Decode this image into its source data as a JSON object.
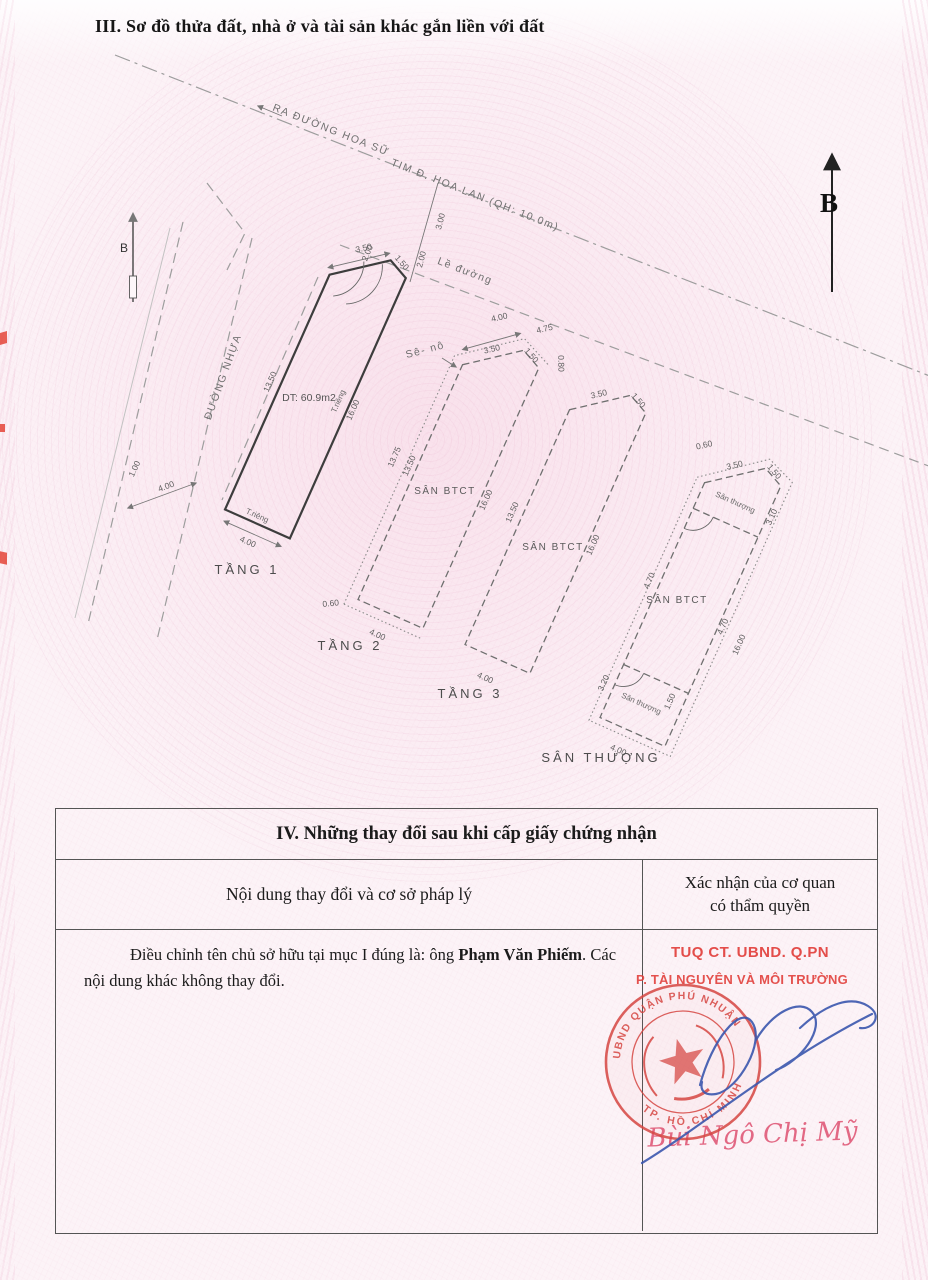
{
  "page": {
    "section3_title": "III. Sơ đồ thửa đất, nhà ở và tài sản khác gắn liền với đất"
  },
  "diagram": {
    "north": "B",
    "hoa_su": "RA ĐƯỜNG HOA SỮ",
    "hoa_lan": "TIM Đ. HOA LAN (QH: 10.0m)",
    "le_duong": "Lề đường",
    "duong_nhua": "ĐƯỜNG NHỰA",
    "road_w1": "4.00",
    "road_w2": "1.00",
    "tick1": "3.00",
    "tick2": "2.00",
    "f1": {
      "label": "TẦNG 1",
      "area": "DT: 60.9m2",
      "wall": "T.riêng",
      "d_chamfer": "3.50",
      "d_top": "1.50",
      "d_offset": "2.00",
      "d_left": "13.50",
      "d_right": "16.00",
      "d_bottom": "4.00"
    },
    "f2": {
      "label": "TẦNG 2",
      "canopy": "Sê- nô",
      "yard": "SÂN BTCT",
      "d_canopy_top": "4.00",
      "d_canopy_diag": "4.75",
      "d_canopy_r": "0.80",
      "d_chamfer": "3.50",
      "d_top": "1.50",
      "d_left_out": "13.75",
      "d_left": "13.50",
      "d_right": "16.00",
      "d_bl": "0.60",
      "d_bottom": "4.00"
    },
    "f3": {
      "label": "TẦNG 3",
      "yard": "SÂN BTCT",
      "d_chamfer": "3.50",
      "d_top": "1.50",
      "d_left": "13.50",
      "d_right": "16.00",
      "d_bottom": "4.00"
    },
    "f4": {
      "label": "SÂN THƯỢNG",
      "terrace": "Sân thượng",
      "yard": "SÂN BTCT",
      "d_tl": "0.60",
      "d_chamfer": "3.50",
      "d_top": "1.50",
      "d_ur": "3.10",
      "d_ml": "4.70",
      "d_mr": "4.70",
      "d_right": "16.00",
      "d_ll": "3.20",
      "d_lr": "1.50",
      "d_bottom": "4.00"
    }
  },
  "section4": {
    "title": "IV. Những thay đổi sau khi cấp giấy chứng nhận",
    "col1_header": "Nội dung thay đổi và cơ sở pháp lý",
    "col2_header_line1": "Xác nhận của cơ quan",
    "col2_header_line2": "có thẩm quyền",
    "entry": {
      "text_before": "Điều chỉnh tên chủ sở hữu tại mục I đúng là: ông",
      "owner_name": "Phạm Văn Phiếm",
      "text_after": ". Các nội dung khác không thay đổi."
    },
    "stamp": {
      "line1": "TUQ CT. UBND. Q.PN",
      "line2": "P. TÀI NGUYÊN VÀ MÔI TRƯỜNG",
      "seal_top": "UBND QUẬN PHÚ NHUẬN",
      "seal_bottom": "TP. HỒ CHÍ MINH",
      "signatory": "Bùi Ngô Chị Mỹ"
    },
    "colors": {
      "stamp_red": "#e2403c",
      "seal_red": "#d64743",
      "signature_blue": "#3b57ae",
      "name_pink": "#e05a78"
    }
  }
}
